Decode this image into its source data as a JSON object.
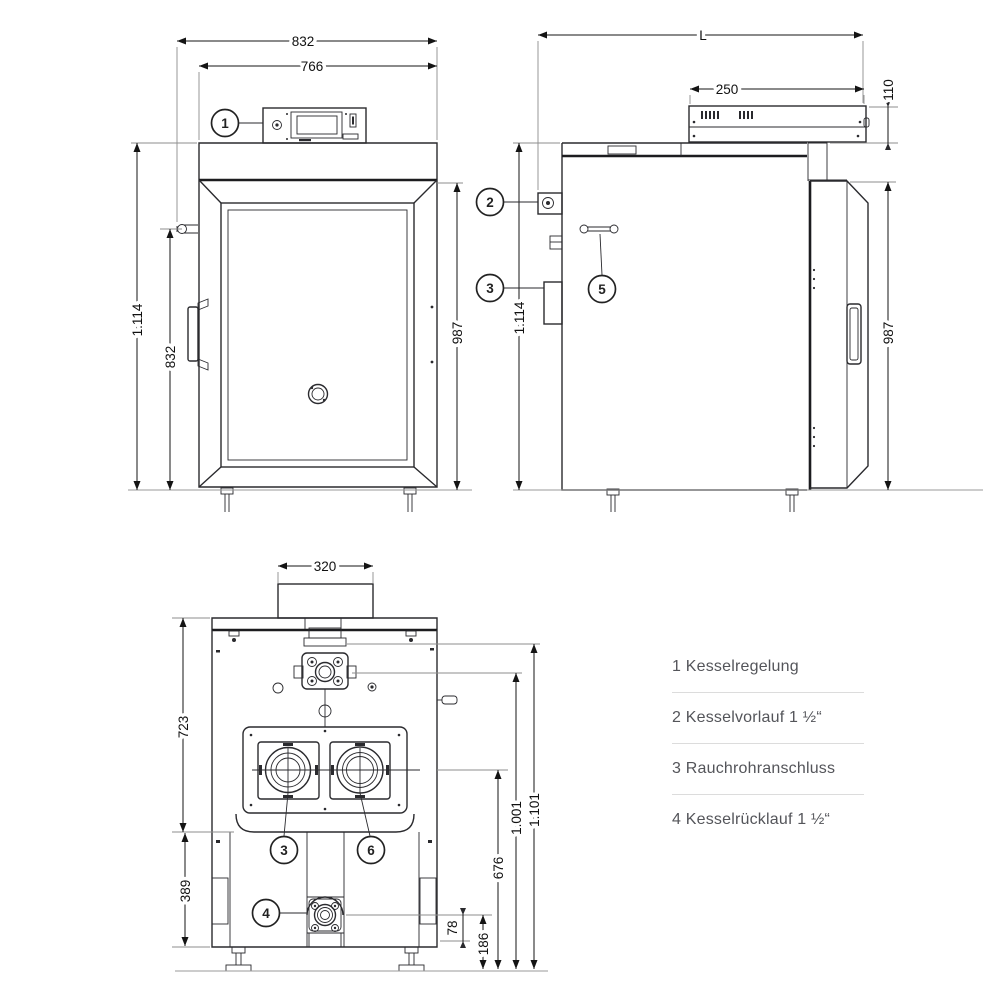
{
  "dims": {
    "front": {
      "total_width": "832",
      "body_width": "766",
      "total_height": "1.114",
      "door_height": "832",
      "body_height": "987"
    },
    "side": {
      "length": "L",
      "panel_width": "250",
      "panel_height": "110",
      "total_height": "1.114",
      "body_height": "987"
    },
    "rear": {
      "flue_width": "320",
      "upper_height": "723",
      "lower_height": "389",
      "flue_center_height": "676",
      "vorlauf_height": "1.001",
      "body_top_height": "1.101",
      "ruecklauf_to_base": "78",
      "ruecklauf_height": "186"
    }
  },
  "callouts": {
    "c1": "1",
    "c2": "2",
    "c3": "3",
    "c4": "4",
    "c5": "5",
    "c6": "6"
  },
  "legend": {
    "items": [
      "1 Kesselregelung",
      "2 Kesselvorlauf 1 ½“",
      "3 Rauchrohranschluss",
      "4 Kesselrücklauf 1 ½“"
    ]
  },
  "colors": {
    "line": "#2a2a2e",
    "dimension": "#141414",
    "extension": "#8c8c8c",
    "legend_text": "#54555a",
    "divider": "#dcdcdc",
    "background": "#ffffff"
  }
}
